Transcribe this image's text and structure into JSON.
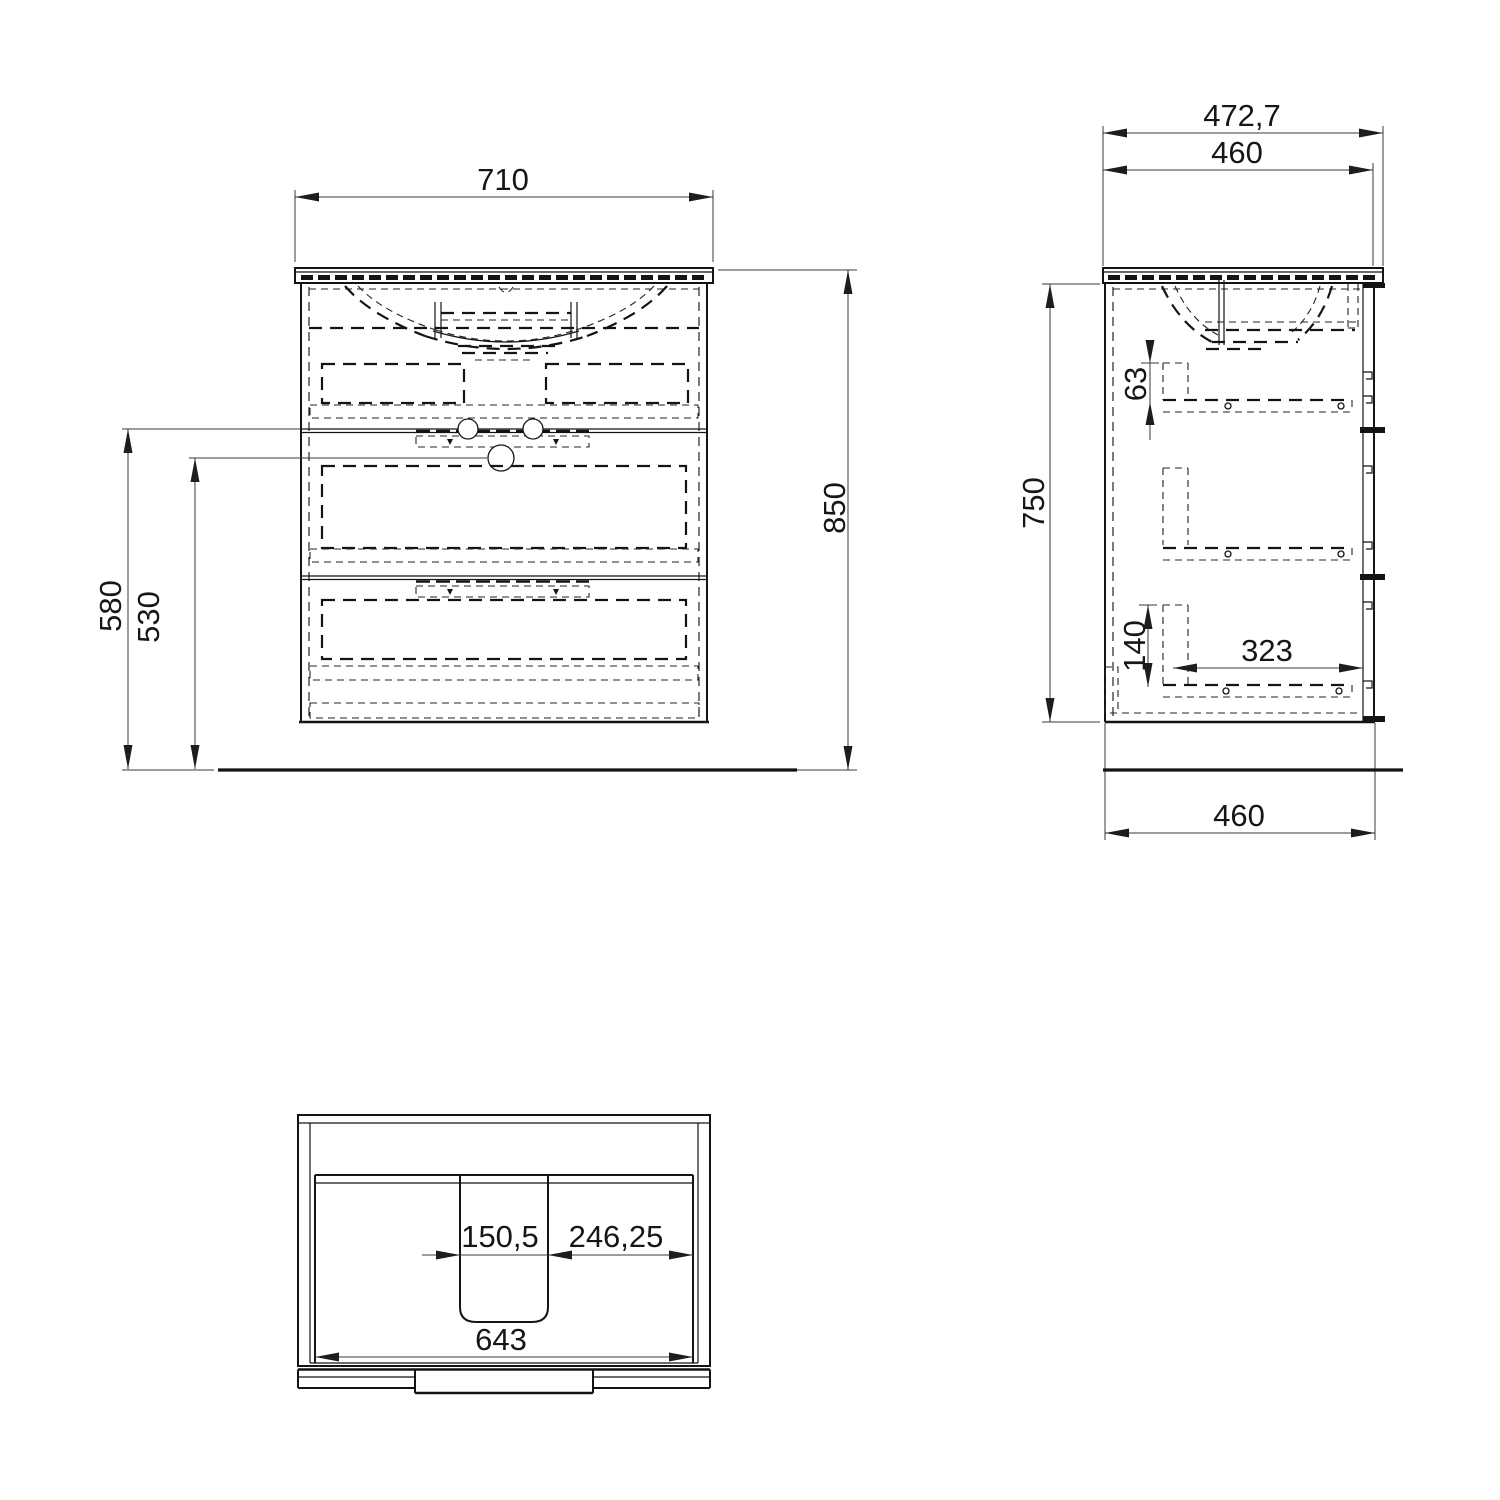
{
  "page": {
    "background": "#ffffff",
    "line_color": "#141414",
    "dim_line_color": "#3a3a3a",
    "description": "three-view technical dimension drawing of a two-drawer washbasin vanity cabinet"
  },
  "views": {
    "front": {
      "name": "front-view",
      "dims": {
        "width": "710",
        "height_overall": "850",
        "height_to_divider": "580",
        "height_to_siphon": "530"
      }
    },
    "side": {
      "name": "side-view",
      "dims": {
        "depth_with_top": "472,7",
        "depth_cabinet": "460",
        "height_cabinet": "750",
        "clearance_top_drawer": "63",
        "clearance_bottom_drawer": "140",
        "depth_drawer": "323",
        "depth_base": "460"
      }
    },
    "plan": {
      "name": "plan-view",
      "dims": {
        "cutout_width": "150,5",
        "cutout_to_side": "246,25",
        "width_inner": "643"
      }
    }
  }
}
